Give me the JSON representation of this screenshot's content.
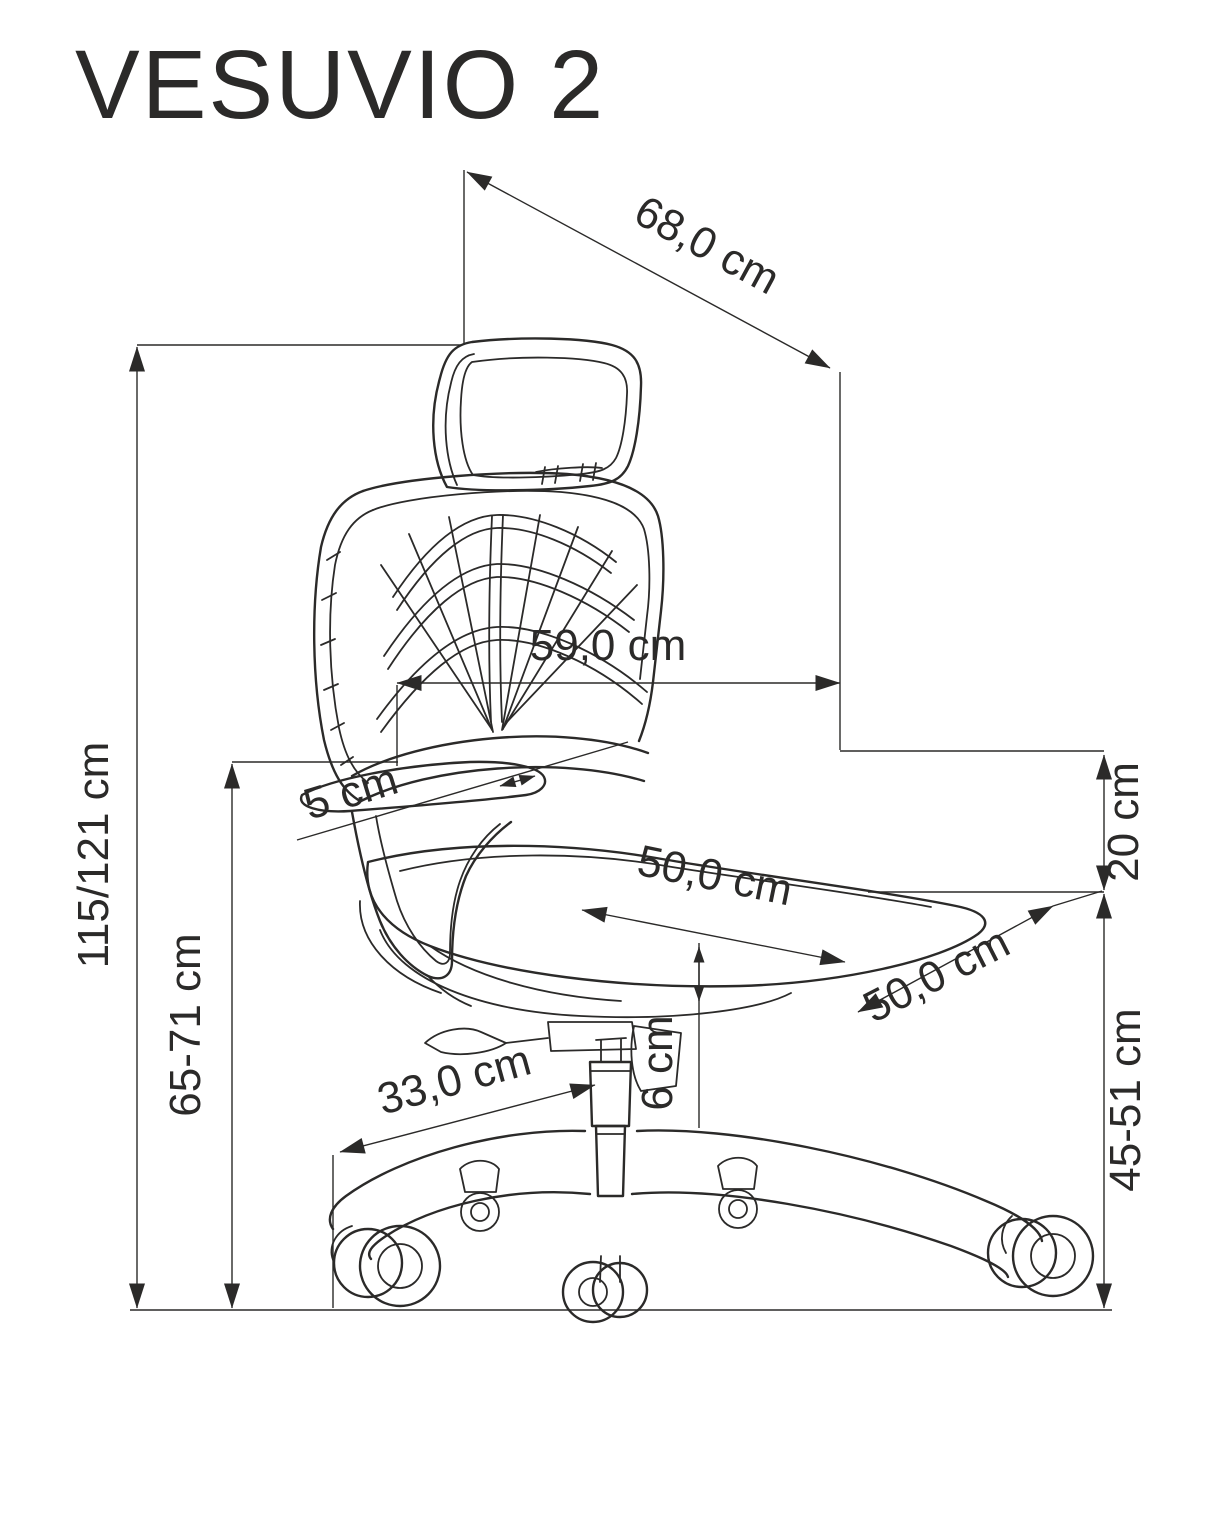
{
  "title": "VESUVIO 2",
  "colors": {
    "ink": "#2b2a29",
    "background": "#ffffff"
  },
  "dimensions": {
    "total_width": "68,0 cm",
    "backrest_width": "59,0 cm",
    "armrest_width": "5 cm",
    "total_height": "115/121 cm",
    "floor_to_armrest": "65-71 cm",
    "backrest_to_seat_drop": "20 cm",
    "seat_width": "50,0 cm",
    "seat_depth": "50,0 cm",
    "seat_cushion_thickness": "6 cm",
    "base_leg_length": "33,0 cm",
    "seat_height": "45-51 cm"
  }
}
